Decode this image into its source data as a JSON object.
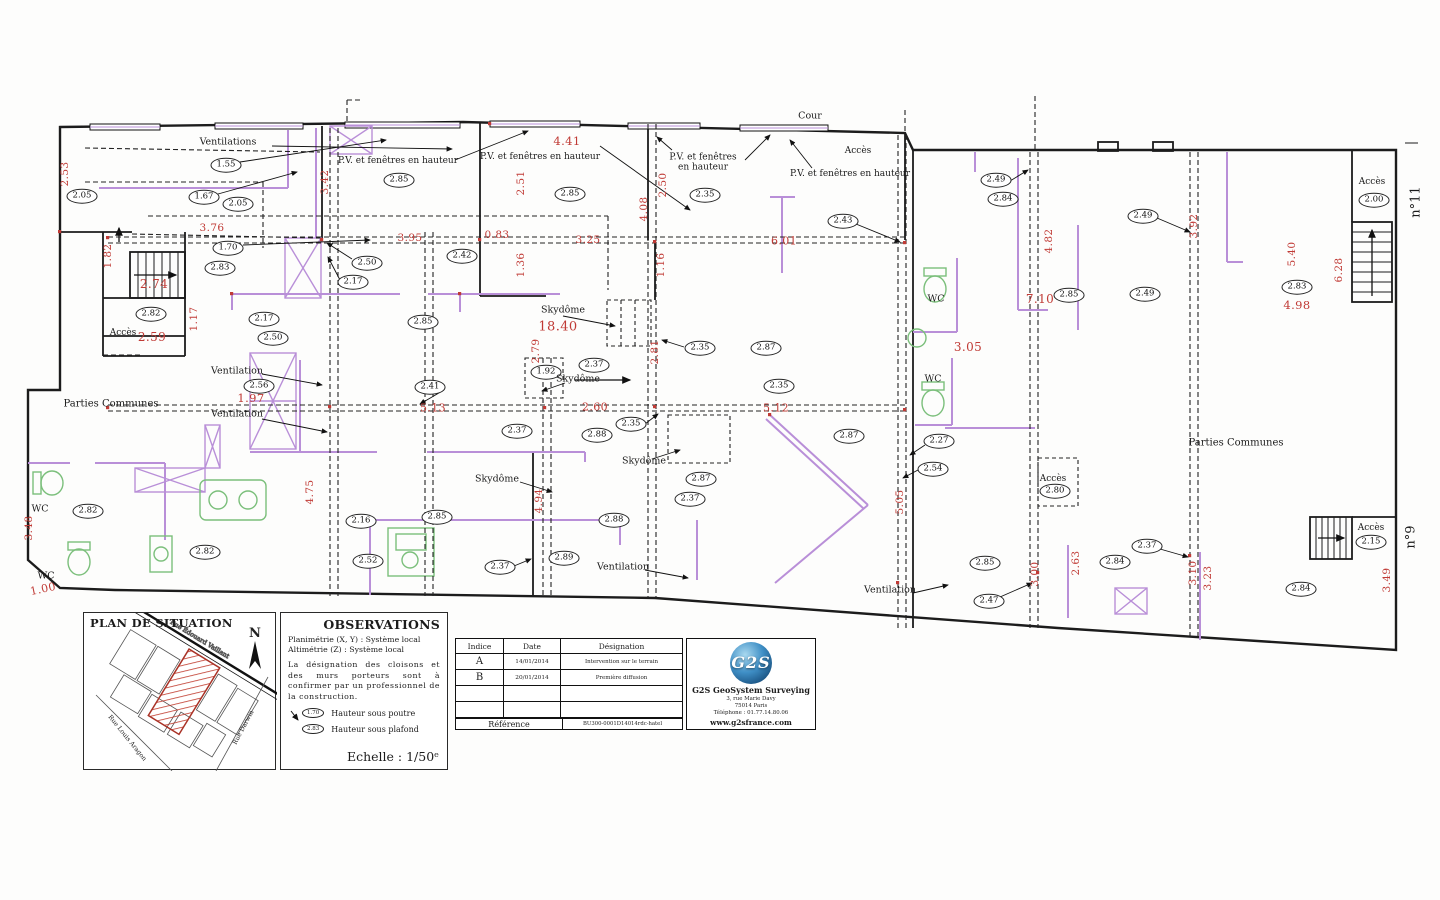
{
  "plan": {
    "ovals": [
      {
        "t": "2.05",
        "x": 82,
        "y": 196
      },
      {
        "t": "1.55",
        "x": 226,
        "y": 165
      },
      {
        "t": "1.67",
        "x": 204,
        "y": 197
      },
      {
        "t": "2.05",
        "x": 238,
        "y": 204
      },
      {
        "t": "1.70",
        "x": 228,
        "y": 248
      },
      {
        "t": "2.83",
        "x": 220,
        "y": 268
      },
      {
        "t": "2.82",
        "x": 151,
        "y": 314
      },
      {
        "t": "2.50",
        "x": 367,
        "y": 263
      },
      {
        "t": "2.17",
        "x": 353,
        "y": 282
      },
      {
        "t": "2.85",
        "x": 399,
        "y": 180
      },
      {
        "t": "2.42",
        "x": 462,
        "y": 256
      },
      {
        "t": "2.85",
        "x": 570,
        "y": 194
      },
      {
        "t": "2.35",
        "x": 705,
        "y": 195
      },
      {
        "t": "2.43",
        "x": 843,
        "y": 221
      },
      {
        "t": "2.49",
        "x": 996,
        "y": 180
      },
      {
        "t": "2.84",
        "x": 1003,
        "y": 199
      },
      {
        "t": "2.49",
        "x": 1143,
        "y": 216
      },
      {
        "t": "2.85",
        "x": 1069,
        "y": 295
      },
      {
        "t": "2.49",
        "x": 1145,
        "y": 294
      },
      {
        "t": "2.83",
        "x": 1297,
        "y": 287
      },
      {
        "t": "2.00",
        "x": 1374,
        "y": 200
      },
      {
        "t": "2.17",
        "x": 264,
        "y": 319
      },
      {
        "t": "2.50",
        "x": 273,
        "y": 338
      },
      {
        "t": "2.85",
        "x": 423,
        "y": 322
      },
      {
        "t": "2.35",
        "x": 700,
        "y": 348
      },
      {
        "t": "2.87",
        "x": 766,
        "y": 348
      },
      {
        "t": "2.56",
        "x": 259,
        "y": 386
      },
      {
        "t": "2.41",
        "x": 430,
        "y": 387
      },
      {
        "t": "1.92",
        "x": 546,
        "y": 372
      },
      {
        "t": "2.37",
        "x": 594,
        "y": 365
      },
      {
        "t": "2.35",
        "x": 779,
        "y": 386
      },
      {
        "t": "2.37",
        "x": 517,
        "y": 431
      },
      {
        "t": "2.35",
        "x": 631,
        "y": 424
      },
      {
        "t": "2.88",
        "x": 597,
        "y": 435
      },
      {
        "t": "2.87",
        "x": 849,
        "y": 436
      },
      {
        "t": "2.27",
        "x": 939,
        "y": 441
      },
      {
        "t": "2.54",
        "x": 933,
        "y": 469
      },
      {
        "t": "2.87",
        "x": 701,
        "y": 479
      },
      {
        "t": "2.37",
        "x": 690,
        "y": 499
      },
      {
        "t": "2.80",
        "x": 1055,
        "y": 491
      },
      {
        "t": "2.16",
        "x": 361,
        "y": 521
      },
      {
        "t": "2.85",
        "x": 437,
        "y": 517
      },
      {
        "t": "2.52",
        "x": 368,
        "y": 561
      },
      {
        "t": "2.37",
        "x": 500,
        "y": 567
      },
      {
        "t": "2.89",
        "x": 564,
        "y": 558
      },
      {
        "t": "2.88",
        "x": 614,
        "y": 520
      },
      {
        "t": "2.82",
        "x": 88,
        "y": 511
      },
      {
        "t": "2.82",
        "x": 205,
        "y": 552
      },
      {
        "t": "2.85",
        "x": 985,
        "y": 563
      },
      {
        "t": "2.47",
        "x": 989,
        "y": 601
      },
      {
        "t": "2.84",
        "x": 1115,
        "y": 562
      },
      {
        "t": "2.37",
        "x": 1147,
        "y": 546
      },
      {
        "t": "2.15",
        "x": 1371,
        "y": 542
      },
      {
        "t": "2.84",
        "x": 1301,
        "y": 589
      }
    ],
    "dims": [
      {
        "t": "4.41",
        "x": 567,
        "y": 141,
        "fs": 11.5
      },
      {
        "t": "3.95",
        "x": 410,
        "y": 238
      },
      {
        "t": "0.83",
        "x": 497,
        "y": 235
      },
      {
        "t": "3.25",
        "x": 588,
        "y": 240
      },
      {
        "t": "6.01",
        "x": 784,
        "y": 241,
        "fs": 11
      },
      {
        "t": "3.76",
        "x": 212,
        "y": 228
      },
      {
        "t": "18.40",
        "x": 558,
        "y": 327,
        "fs": 13
      },
      {
        "t": "2.59",
        "x": 152,
        "y": 337,
        "fs": 12
      },
      {
        "t": "2.74",
        "x": 154,
        "y": 284,
        "fs": 12
      },
      {
        "t": "1.97",
        "x": 251,
        "y": 398,
        "fs": 11.5
      },
      {
        "t": "5.13",
        "x": 433,
        "y": 408,
        "fs": 11
      },
      {
        "t": "2.60",
        "x": 595,
        "y": 407,
        "fs": 11
      },
      {
        "t": "5.12",
        "x": 776,
        "y": 408,
        "fs": 11
      },
      {
        "t": "3.05",
        "x": 968,
        "y": 347,
        "fs": 12
      },
      {
        "t": "7.10",
        "x": 1040,
        "y": 299,
        "fs": 12
      },
      {
        "t": "4.98",
        "x": 1297,
        "y": 305,
        "fs": 11.5
      },
      {
        "t": "1.00",
        "x": 43,
        "y": 589,
        "r": -12,
        "fs": 11
      },
      {
        "t": "2.53",
        "x": 65,
        "y": 174,
        "r": -90
      },
      {
        "t": "1.82",
        "x": 108,
        "y": 256,
        "r": -90
      },
      {
        "t": "1.17",
        "x": 194,
        "y": 319,
        "r": -90
      },
      {
        "t": "3.42",
        "x": 325,
        "y": 182,
        "r": -90
      },
      {
        "t": "2.51",
        "x": 521,
        "y": 183,
        "r": -90
      },
      {
        "t": "1.36",
        "x": 521,
        "y": 265,
        "r": -90
      },
      {
        "t": "2.50",
        "x": 663,
        "y": 185,
        "r": -90
      },
      {
        "t": "4.08",
        "x": 644,
        "y": 209,
        "r": -90
      },
      {
        "t": "1.16",
        "x": 661,
        "y": 265,
        "r": -90
      },
      {
        "t": "2.79",
        "x": 536,
        "y": 351,
        "r": -90
      },
      {
        "t": "2.81",
        "x": 655,
        "y": 352,
        "r": -90
      },
      {
        "t": "4.82",
        "x": 1049,
        "y": 241,
        "r": -90
      },
      {
        "t": "3.92",
        "x": 1194,
        "y": 226,
        "r": -90
      },
      {
        "t": "5.40",
        "x": 1292,
        "y": 254,
        "r": -90
      },
      {
        "t": "6.28",
        "x": 1339,
        "y": 270,
        "r": -90
      },
      {
        "t": "4.75",
        "x": 310,
        "y": 492,
        "r": -90
      },
      {
        "t": "4.94",
        "x": 539,
        "y": 501,
        "r": -90
      },
      {
        "t": "3.48",
        "x": 29,
        "y": 528,
        "r": -90
      },
      {
        "t": "5.05",
        "x": 900,
        "y": 502,
        "r": -90
      },
      {
        "t": "3.00",
        "x": 1035,
        "y": 574,
        "r": -90
      },
      {
        "t": "2.63",
        "x": 1076,
        "y": 563,
        "r": -90
      },
      {
        "t": "3.10",
        "x": 1193,
        "y": 573,
        "r": -90
      },
      {
        "t": "3.23",
        "x": 1208,
        "y": 578,
        "r": -90
      },
      {
        "t": "3.49",
        "x": 1387,
        "y": 580,
        "r": -90
      }
    ],
    "notes": [
      {
        "t": "Cour",
        "x": 810,
        "y": 117
      },
      {
        "t": "Ventilations",
        "x": 228,
        "y": 143
      },
      {
        "t": "P.V. et fenêtres en hauteur",
        "x": 398,
        "y": 161,
        "fs": 9
      },
      {
        "t": "P.V. et fenêtres en hauteur",
        "x": 540,
        "y": 157,
        "fs": 9
      },
      {
        "t": "P.V. et fenêtres\nen hauteur",
        "x": 703,
        "y": 163,
        "fs": 9
      },
      {
        "t": "P.V. et fenêtres en hauteur",
        "x": 850,
        "y": 174,
        "fs": 9
      },
      {
        "t": "Accès",
        "x": 858,
        "y": 151,
        "fs": 9
      },
      {
        "t": "Accès",
        "x": 1372,
        "y": 182,
        "fs": 9
      },
      {
        "t": "Accès",
        "x": 123,
        "y": 333,
        "fs": 9
      },
      {
        "t": "Accès",
        "x": 1053,
        "y": 479,
        "fs": 9
      },
      {
        "t": "Accès",
        "x": 1371,
        "y": 528,
        "fs": 9
      },
      {
        "t": "n°11",
        "x": 1417,
        "y": 202,
        "r": -90,
        "fs": 13
      },
      {
        "t": "n°9",
        "x": 1412,
        "y": 537,
        "r": -90,
        "fs": 13
      },
      {
        "t": "Skydôme",
        "x": 563,
        "y": 311
      },
      {
        "t": "Skydôme",
        "x": 578,
        "y": 380
      },
      {
        "t": "Skydôme",
        "x": 497,
        "y": 480
      },
      {
        "t": "Skydôme",
        "x": 644,
        "y": 462
      },
      {
        "t": "WC",
        "x": 936,
        "y": 300
      },
      {
        "t": "WC",
        "x": 933,
        "y": 380
      },
      {
        "t": "WC",
        "x": 40,
        "y": 510
      },
      {
        "t": "WC",
        "x": 46,
        "y": 577
      },
      {
        "t": "Ventilation",
        "x": 237,
        "y": 372
      },
      {
        "t": "Ventilation",
        "x": 237,
        "y": 415
      },
      {
        "t": "Ventilation",
        "x": 623,
        "y": 568
      },
      {
        "t": "Ventilation",
        "x": 890,
        "y": 591
      },
      {
        "t": "Parties Communes",
        "x": 111,
        "y": 404,
        "fs": 10
      },
      {
        "t": "Parties Communes",
        "x": 1236,
        "y": 443,
        "fs": 10
      }
    ]
  },
  "situation": {
    "title": "PLAN DE SITUATION",
    "north": "N",
    "streets": [
      "Rue Édouard Vaillant",
      "Rue Louis Aragon",
      "Rue Darwin"
    ]
  },
  "observations": {
    "title": "OBSERVATIONS",
    "line1": "Planimétrie (X, Y) : Système local",
    "line2": "Altimétrie (Z) : Système local",
    "paragraph": "La désignation des cloisons et des murs porteurs sont à confirmer par un professionnel de la construction.",
    "legend": [
      {
        "badge": "1.70",
        "label": "Hauteur sous poutre"
      },
      {
        "badge": "2.83",
        "label": "Hauteur sous plafond"
      }
    ],
    "scale": "Echelle : 1/50ᵉ"
  },
  "titleblock": {
    "headers": [
      "Indice",
      "Date",
      "Désignation"
    ],
    "rows": [
      {
        "indice": "A",
        "date": "14/01/2014",
        "designation": "Intervention sur le terrain"
      },
      {
        "indice": "B",
        "date": "20/01/2014",
        "designation": "Première diffusion"
      },
      {
        "indice": "",
        "date": "",
        "designation": ""
      },
      {
        "indice": "",
        "date": "",
        "designation": ""
      }
    ],
    "reference_label": "Référence",
    "reference_value": "BU300-0001D14014rdc-hatel"
  },
  "company": {
    "logo": "G2S",
    "name": "G2S GeoSystem Surveying",
    "address1": "3, rue Marie Davy",
    "address2": "75014 Paris",
    "phone": "Téléphone : 01.77.14.80.06",
    "website": "www.g2sfrance.com"
  },
  "colors": {
    "wall": "#1c1c1c",
    "partition": "#b98fd8",
    "dimension_red": "#c03a35",
    "fixture_green": "#7bbf7b",
    "logo_blue": "#0b3a66"
  }
}
